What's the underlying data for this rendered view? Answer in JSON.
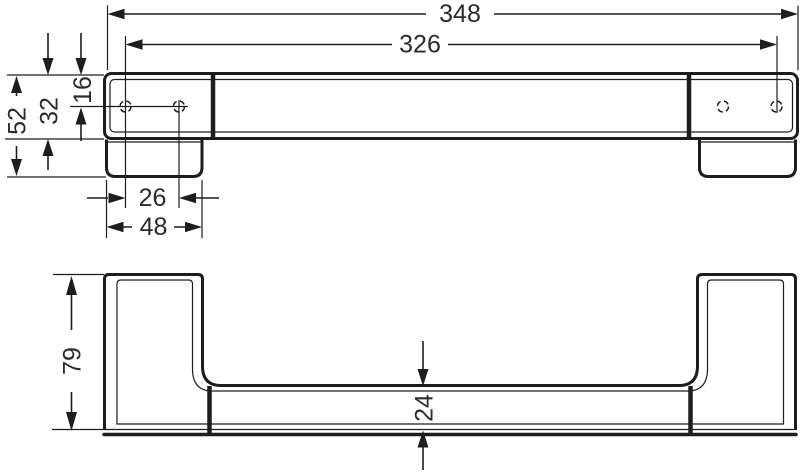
{
  "drawing": {
    "type": "technical-dimension-drawing",
    "subject": "wall-mounted grab bar shown in plan view and front elevation",
    "units": "mm",
    "background": "#ffffff",
    "line_color": "#1d1d1b",
    "text_color": "#2b2b2b",
    "top_view": {
      "dims": {
        "overall_length": "348",
        "hole_distance": "326",
        "depth_total": "52",
        "depth_body": "32",
        "hole_offset": "16",
        "hole_pair_spacing": "26",
        "base_plate_width": "48"
      }
    },
    "front_view": {
      "dims": {
        "overall_height": "79",
        "bar_thickness": "24"
      }
    }
  }
}
